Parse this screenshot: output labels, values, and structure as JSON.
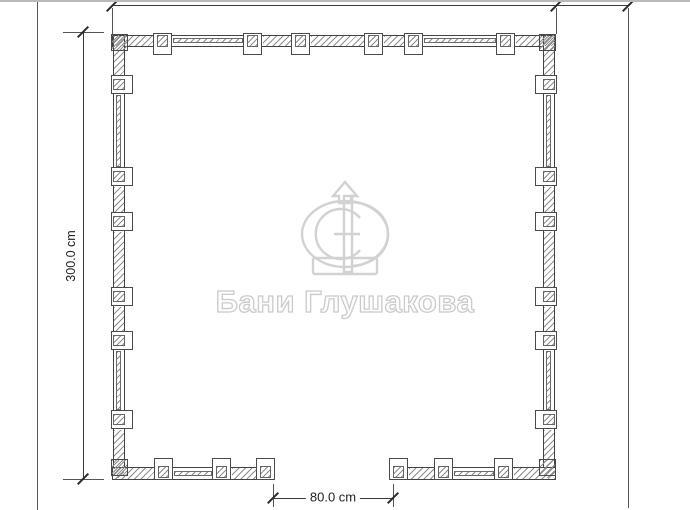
{
  "watermark": {
    "brand_text": "Бани Глушакова",
    "logo_monogram": "GD"
  },
  "dimensions": {
    "top_overall": "300.0 cm",
    "top_right_extension": "50.0 cm",
    "left_overall": "300.0 cm",
    "door_opening": "80.0 cm"
  }
}
